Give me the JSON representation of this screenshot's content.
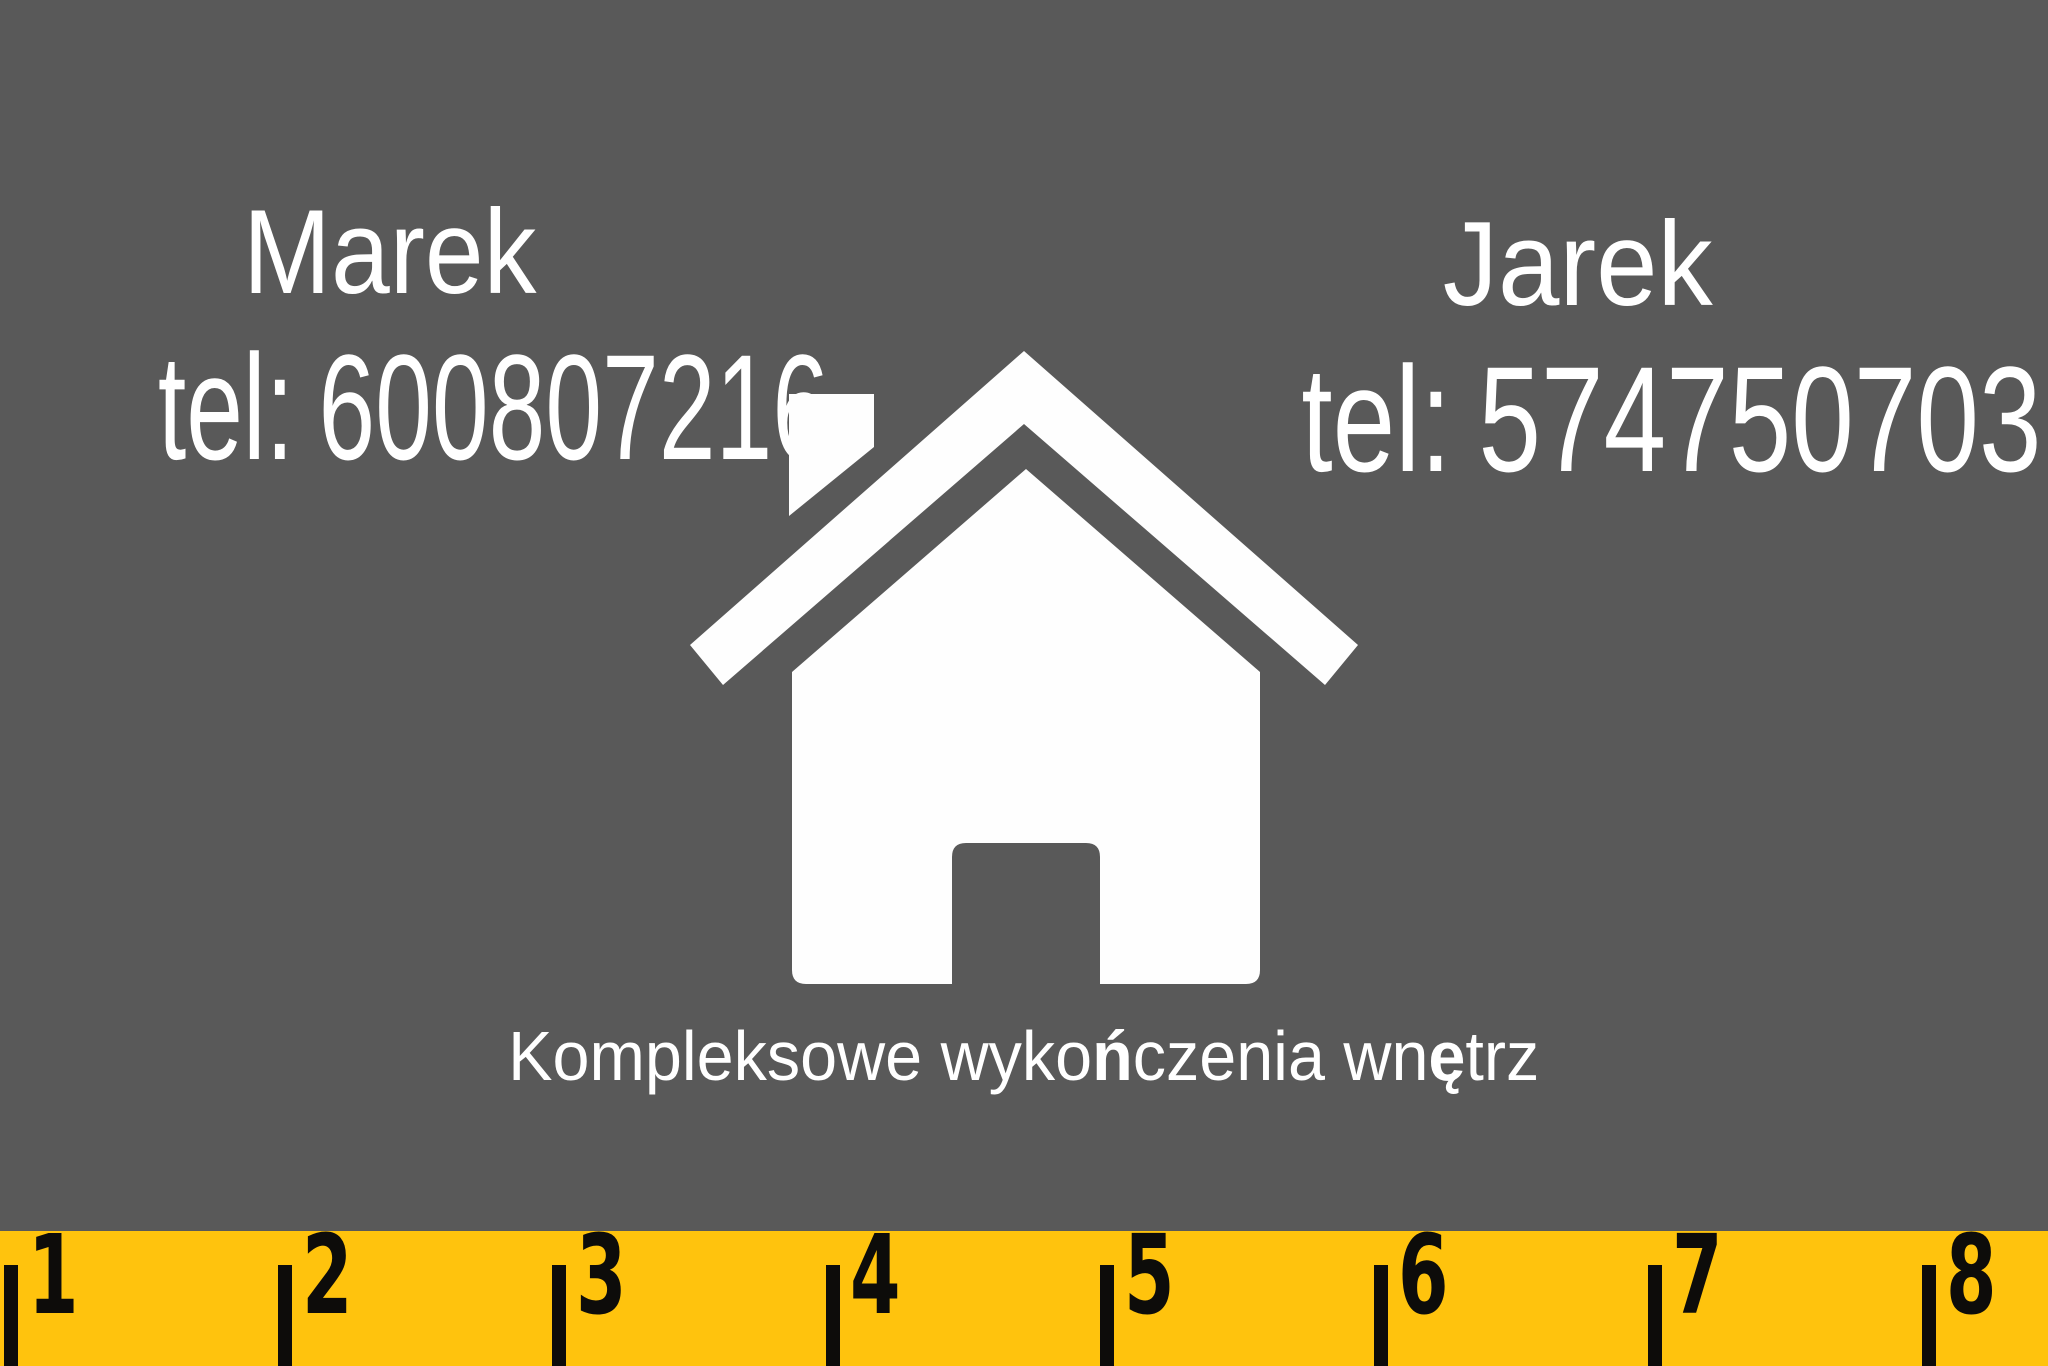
{
  "card": {
    "contacts": [
      {
        "name": "Marek",
        "tel_prefix": "tel:",
        "phone": "600807216"
      },
      {
        "name": "Jarek",
        "tel_prefix": "tel:",
        "phone": "574750703"
      }
    ],
    "icon": "house-icon",
    "slogan": {
      "text": "Kompleksowe wykończenia wnętrz",
      "segments": [
        {
          "text": "Kompleksowe wyko",
          "bold": false
        },
        {
          "text": "ń",
          "bold": true
        },
        {
          "text": "czenia wn",
          "bold": false
        },
        {
          "text": "ę",
          "bold": true
        },
        {
          "text": "trz",
          "bold": false
        }
      ]
    },
    "ruler": {
      "marks": [
        "1",
        "2",
        "3",
        "4",
        "5",
        "6",
        "7",
        "8"
      ]
    },
    "colors": {
      "background": "#595959",
      "text": "#ffffff",
      "icon": "#ffffff",
      "ruler_background": "#ffc30d",
      "ruler_ink": "#0d0c0a"
    }
  }
}
